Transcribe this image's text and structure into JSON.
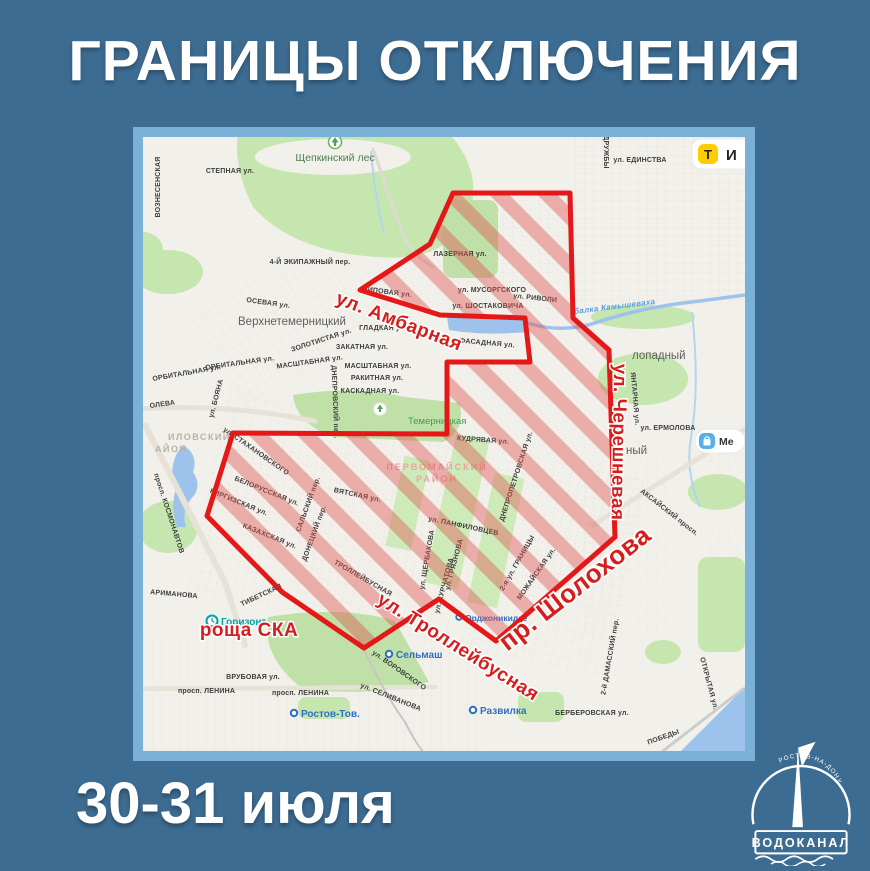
{
  "title": "ГРАНИЦЫ ОТКЛЮЧЕНИЯ",
  "date_range": "30-31 июля",
  "colors": {
    "background": "#3d6c92",
    "map_frame": "#7cb1d7",
    "zone_border_red": "#e41818",
    "zone_hatch_red": "#e05050",
    "map_land": "#f2f0ea",
    "map_water": "#9dc3ec",
    "map_green": "#c5e6ae",
    "taxi_yellow": "#ffcc00"
  },
  "logo": {
    "org": "ВОДОКАНАЛ",
    "city": "РОСТОВ-НА-ДОНУ"
  },
  "map": {
    "zone_labels": {
      "ambarnaya": "ул. Амбарная",
      "chereshnevaya": "ул. Черешневая",
      "sholokhova": "пр. Шолохова",
      "trolleybusnaya": "ул. Троллейбусная",
      "roscha_ska": "роща СКА"
    },
    "chips": {
      "taxi_letter": "T",
      "taxi_text": "И",
      "mall_text": "Ме"
    },
    "districts": {
      "pervomaysky_line1": "ПЕРВОМАЙСКИЙ",
      "pervomaysky_line2": "РАЙОН",
      "voroshilovsky_line1": "ИЛОВСКИЙ",
      "voroshilovsky_line2": "АЙОН"
    },
    "places": {
      "schepkinsky_les": "Щепкинский лес",
      "verkhnetemernitsky": "Верхнетемерницкий",
      "temernitskaya": "Темерницкая",
      "listopadny": "лопадный",
      "severny": "ный",
      "gorizont": "Горизонт",
      "selmash": "Сельмаш",
      "rostov_tov": "Ростов-Тов.",
      "razvilka": "Развилка",
      "ordzhonikidze": "Орджоникидзе",
      "water_stream": "балка Камышеваха"
    },
    "streets": {
      "stepnaya": "СТЕПНАЯ ул.",
      "voznesenskaya": "ВОЗНЕСЕНСКАЯ",
      "ekipazhny": "4-Й ЭКИПАЖНЫЙ пер.",
      "osevaya": "ОСЕВАЯ ул.",
      "druzhby": "ДРУЖБЫ",
      "edinstva": "ул. ЕДИНСТВА",
      "lazernaya": "ЛАЗЕРНАЯ ул.",
      "musorgskogo": "ул. МУСОРГСКОГО",
      "shostakovicha": "ул. ШОСТАКОВИЧА",
      "rivoli": "ул. РИВОЛИ",
      "lipovaya": "ЛИПОВАЯ ул.",
      "gladkaya": "ГЛАДКАЯ ул.",
      "zolotistaya": "ЗОЛОТИСТАЯ ул.",
      "zakatnaya": "ЗАКАТНАЯ ул.",
      "masshtabnaya": "МАСШТАБНАЯ ул.",
      "orbitalnaya": "ОРБИТАЛЬНАЯ ул.",
      "rakitnaya": "РАКИТНАЯ ул.",
      "kaskadnaya": "КАСКАДНАЯ ул.",
      "boyana": "ул. БОЯНА",
      "koroleva": "ОЛЕВА",
      "dneprovsky": "ДНЕПРОВСКИЙ пер.",
      "fasadnaya": "ФАСАДНАЯ ул.",
      "yantarnaya": "ЯНТАРНАЯ ул.",
      "ermolova": "ул. ЕРМОЛОВА",
      "kudryavaya": "КУДРЯВАЯ ул.",
      "stakhanovskogo": "ул. СТАХАНОВСКОГО",
      "vyatskaya": "ВЯТСКАЯ ул.",
      "belorusskaya": "БЕЛОРУССКАЯ ул.",
      "kirgizskaya": "КИРГИЗСКАЯ ул.",
      "kazakhskaya": "КАЗАХСКАЯ ул.",
      "salsky": "САЛЬСКИЙ пер.",
      "donetsky": "ДОНЕЦКИЙ пер.",
      "kosmonavtov": "просп. КОСМОНАВТОВ",
      "panfilovtsev": "ул. ПАНФИЛОВЦЕВ",
      "dnepropetrovskaya": "ДНЕПРОПЕТРОВСКАЯ ул.",
      "shcherbakova": "ул. ЩЕРБАКОВА",
      "gryaznova": "ул. ГРЯЗНОВА",
      "kurchatova": "ул. КУРЧАТОВА",
      "trolleybusnaya_street": "ТРОЛЛЕЙБУСНАЯ",
      "granitsy": "2-я ул. ГРАНИЦЫ",
      "mozhayskaya": "МОЖАЙСКАЯ ул.",
      "aksaysky": "АКСАЙСКИЙ просп.",
      "tibetskaya": "ТИБЕТСКАЯ",
      "arimanova": "АРИМАНОВА",
      "vrubovaya": "ВРУБОВАЯ ул.",
      "lenina": "просп. ЛЕНИНА",
      "vorovskogo": "ул. ВОРОВСКОГО",
      "selivanova": "ул. СЕЛИВАНОВА",
      "berberovskaya": "БЕРБЕРОВСКАЯ ул.",
      "damassky": "2-й ДАМАССКИЙ пер.",
      "otkrytaya": "ОТКРЫТАЯ ул.",
      "pobedy": "ПОБЕДЫ"
    }
  }
}
